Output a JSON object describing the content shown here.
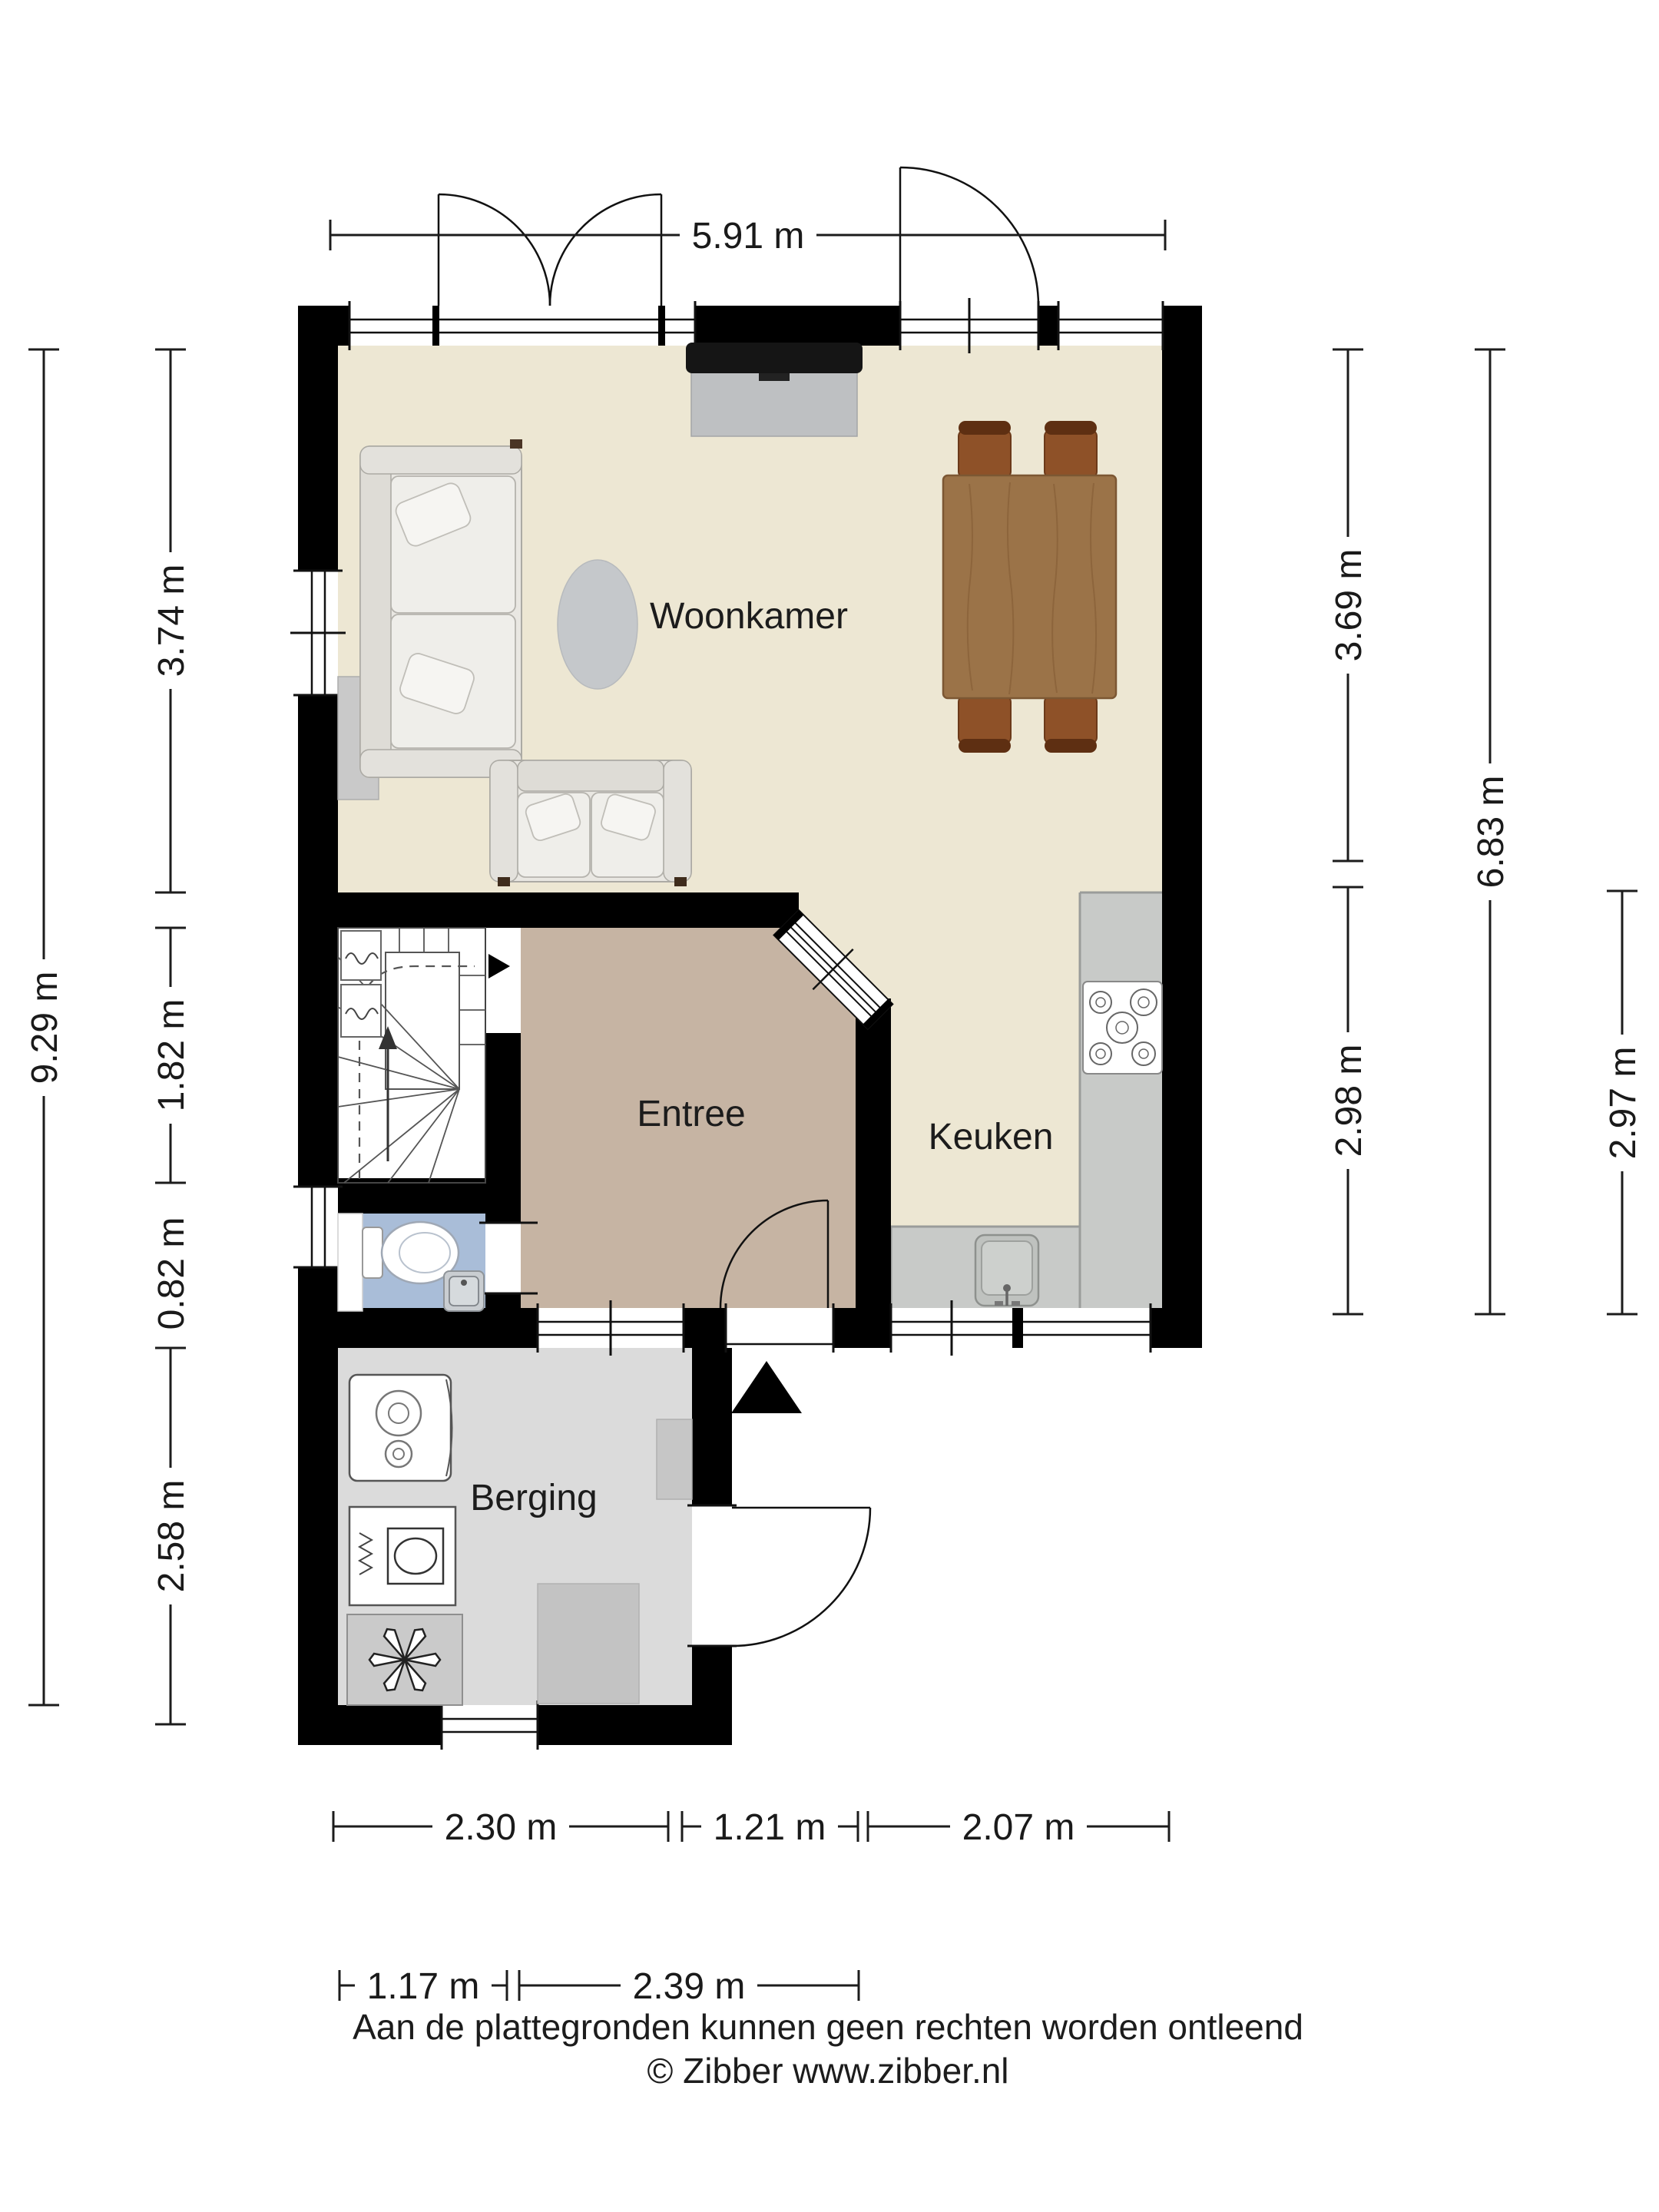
{
  "plan": {
    "type": "floor-plan",
    "floor": "begane grond",
    "rooms": {
      "woonkamer": {
        "label": "Woonkamer"
      },
      "entree": {
        "label": "Entree"
      },
      "keuken": {
        "label": "Keuken"
      },
      "berging": {
        "label": "Berging"
      }
    },
    "features": [
      "stairs",
      "toilet",
      "hand-basin",
      "gas-hob",
      "kitchen-sink",
      "boiler",
      "washing-machine",
      "ventilation-unit",
      "sofa-large",
      "sofa-small",
      "rug",
      "dining-table",
      "dining-chairs",
      "tv",
      "tv-cabinet",
      "entrance-marker"
    ]
  },
  "dims": {
    "width_total": "5.91 m",
    "height_total": "9.29 m",
    "woonkamer_left": "3.74 m",
    "stairs_left": "1.82 m",
    "toilet_left": "0.82 m",
    "berging_left": "2.58 m",
    "woonkamer_right": "3.69 m",
    "keuken_right": "2.98 m",
    "right_total": "6.83 m",
    "keuken_far_right": "2.97 m",
    "bottom_berging": "2.30 m",
    "bottom_entrance": "1.21 m",
    "bottom_keuken": "2.07 m",
    "bottom2_left": "1.17 m",
    "bottom2_mid": "2.39 m"
  },
  "footer": {
    "disclaimer": "Aan de plattegronden kunnen geen rechten worden ontleend",
    "copyright": "© Zibber www.zibber.nl"
  },
  "colors": {
    "wall": "#000000",
    "woonkamer_floor": "#EDE7D3",
    "entree_floor": "#C6B4A3",
    "toilet_floor": "#A9BDD8",
    "berging_floor": "#DBDBDB",
    "counter": "#C8CAC8",
    "table_wood": "#9B7348",
    "chair_wood": "#8E5128"
  }
}
